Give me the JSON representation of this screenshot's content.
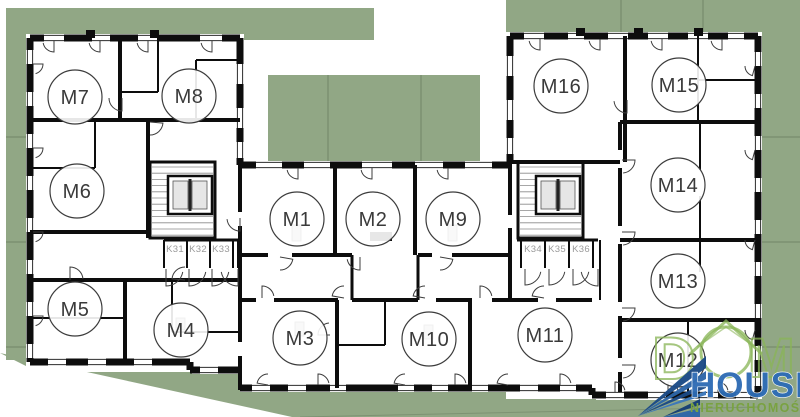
{
  "plan": {
    "apartments": [
      {
        "label": "M7",
        "x": 75,
        "y": 97
      },
      {
        "label": "M8",
        "x": 189,
        "y": 96
      },
      {
        "label": "M6",
        "x": 77,
        "y": 191
      },
      {
        "label": "M5",
        "x": 75,
        "y": 309
      },
      {
        "label": "M4",
        "x": 181,
        "y": 330
      },
      {
        "label": "M1",
        "x": 297,
        "y": 219
      },
      {
        "label": "M2",
        "x": 373,
        "y": 219
      },
      {
        "label": "M9",
        "x": 453,
        "y": 219
      },
      {
        "label": "M3",
        "x": 300,
        "y": 338
      },
      {
        "label": "M10",
        "x": 429,
        "y": 339
      },
      {
        "label": "M11",
        "x": 545,
        "y": 335
      },
      {
        "label": "M16",
        "x": 561,
        "y": 86
      },
      {
        "label": "M15",
        "x": 679,
        "y": 85
      },
      {
        "label": "M14",
        "x": 678,
        "y": 185
      },
      {
        "label": "M13",
        "x": 678,
        "y": 281
      },
      {
        "label": "M12",
        "x": 678,
        "y": 360
      }
    ],
    "storage_units": [
      {
        "label": "K31",
        "x": 175,
        "y": 252
      },
      {
        "label": "K32",
        "x": 198,
        "y": 252
      },
      {
        "label": "K33",
        "x": 221,
        "y": 252
      },
      {
        "label": "K34",
        "x": 533,
        "y": 252
      },
      {
        "label": "K35",
        "x": 557,
        "y": 252
      },
      {
        "label": "K36",
        "x": 581,
        "y": 252
      }
    ]
  },
  "logo": {
    "dom_d": "D",
    "dom_m": "M",
    "house": "HOUSE",
    "tagline": "NIERUCHOMOŚCI"
  },
  "colors": {
    "grass": "#91a785",
    "wall": "#0d0d0d",
    "logo_blue": "#2e6cb5",
    "logo_green": "#8ab558",
    "tagline_green": "#79a23f"
  }
}
